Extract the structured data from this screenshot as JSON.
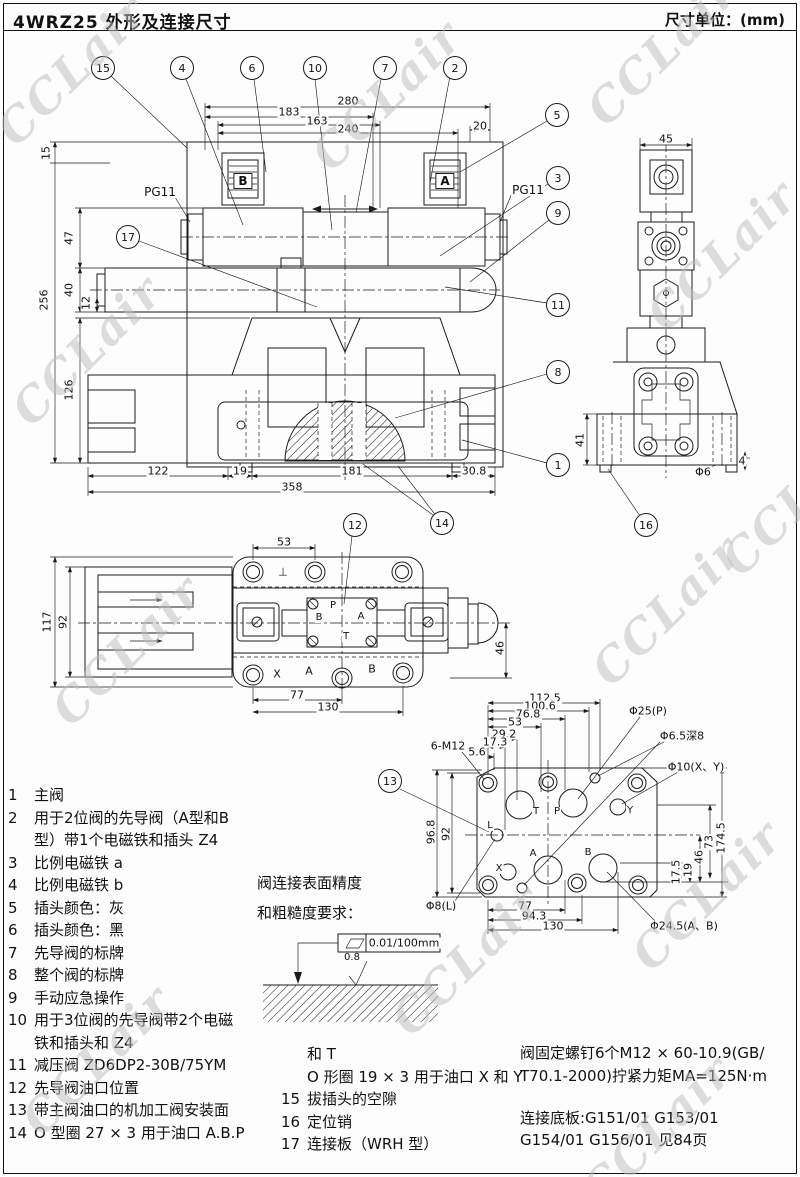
{
  "header": {
    "title": "4WRZ25 外形及连接尺寸",
    "unit": "尺寸单位：(mm)"
  },
  "watermark": {
    "text": "CCLair",
    "positions": [
      {
        "x": 5,
        "y": 110
      },
      {
        "x": 320,
        "y": 135
      },
      {
        "x": 595,
        "y": 90
      },
      {
        "x": 20,
        "y": 390
      },
      {
        "x": 655,
        "y": 295
      },
      {
        "x": 60,
        "y": 690
      },
      {
        "x": 600,
        "y": 650
      },
      {
        "x": 730,
        "y": 540
      },
      {
        "x": 400,
        "y": 1000
      },
      {
        "x": 640,
        "y": 935
      },
      {
        "x": 590,
        "y": 1170
      },
      {
        "x": 30,
        "y": 1100
      }
    ]
  },
  "annotations": {
    "callouts": [
      {
        "n": "15",
        "x": 103,
        "y": 68
      },
      {
        "n": "4",
        "x": 182,
        "y": 68
      },
      {
        "n": "6",
        "x": 252,
        "y": 68
      },
      {
        "n": "10",
        "x": 315,
        "y": 68
      },
      {
        "n": "7",
        "x": 385,
        "y": 68
      },
      {
        "n": "2",
        "x": 455,
        "y": 68
      },
      {
        "n": "5",
        "x": 557,
        "y": 115
      },
      {
        "n": "3",
        "x": 558,
        "y": 178
      },
      {
        "n": "9",
        "x": 558,
        "y": 213
      },
      {
        "n": "11",
        "x": 558,
        "y": 305
      },
      {
        "n": "8",
        "x": 558,
        "y": 372
      },
      {
        "n": "1",
        "x": 558,
        "y": 465
      },
      {
        "n": "17",
        "x": 128,
        "y": 237
      },
      {
        "n": "12",
        "x": 355,
        "y": 525
      },
      {
        "n": "14",
        "x": 442,
        "y": 523
      },
      {
        "n": "16",
        "x": 646,
        "y": 525
      },
      {
        "n": "13",
        "x": 390,
        "y": 781
      }
    ],
    "dims": [
      {
        "t": "280",
        "x": 348,
        "y": 101
      },
      {
        "t": "183",
        "x": 289,
        "y": 112
      },
      {
        "t": "163",
        "x": 317,
        "y": 121
      },
      {
        "t": "240",
        "x": 348,
        "y": 129
      },
      {
        "t": "20",
        "x": 480,
        "y": 126
      },
      {
        "t": "122",
        "x": 158,
        "y": 471
      },
      {
        "t": "19",
        "x": 240,
        "y": 471
      },
      {
        "t": "181",
        "x": 352,
        "y": 471
      },
      {
        "t": "30.8",
        "x": 474,
        "y": 471
      },
      {
        "t": "358",
        "x": 292,
        "y": 487
      },
      {
        "t": "15",
        "x": 46,
        "y": 153,
        "rot": 1
      },
      {
        "t": "256",
        "x": 44,
        "y": 300,
        "rot": 1
      },
      {
        "t": "47",
        "x": 69,
        "y": 238,
        "rot": 1
      },
      {
        "t": "40",
        "x": 69,
        "y": 290,
        "rot": 1
      },
      {
        "t": "12",
        "x": 86,
        "y": 303,
        "rot": 1
      },
      {
        "t": "126",
        "x": 69,
        "y": 390,
        "rot": 1
      },
      {
        "t": "45",
        "x": 666,
        "y": 139
      },
      {
        "t": "41",
        "x": 580,
        "y": 440,
        "rot": 1
      },
      {
        "t": "4",
        "x": 742,
        "y": 461
      },
      {
        "t": "53",
        "x": 284,
        "y": 542
      },
      {
        "t": "117",
        "x": 47,
        "y": 622,
        "rot": 1
      },
      {
        "t": "92",
        "x": 63,
        "y": 622,
        "rot": 1
      },
      {
        "t": "77",
        "x": 297,
        "y": 695
      },
      {
        "t": "130",
        "x": 328,
        "y": 707
      },
      {
        "t": "46",
        "x": 500,
        "y": 648,
        "rot": 1
      },
      {
        "t": "112.5",
        "x": 545,
        "y": 698
      },
      {
        "t": "100.6",
        "x": 540,
        "y": 706
      },
      {
        "t": "76.8",
        "x": 528,
        "y": 714
      },
      {
        "t": "53",
        "x": 515,
        "y": 722
      },
      {
        "t": "29.2",
        "x": 504,
        "y": 734
      },
      {
        "t": "17.3",
        "x": 495,
        "y": 742
      },
      {
        "t": "5.6",
        "x": 477,
        "y": 752
      },
      {
        "t": "96.8",
        "x": 431,
        "y": 832,
        "rot": 1
      },
      {
        "t": "92",
        "x": 446,
        "y": 834,
        "rot": 1
      },
      {
        "t": "17.5",
        "x": 676,
        "y": 872,
        "rot": 1
      },
      {
        "t": "19",
        "x": 688,
        "y": 870,
        "rot": 1
      },
      {
        "t": "46",
        "x": 699,
        "y": 857,
        "rot": 1
      },
      {
        "t": "73",
        "x": 709,
        "y": 842,
        "rot": 1
      },
      {
        "t": "174.5",
        "x": 721,
        "y": 838,
        "rot": 1
      },
      {
        "t": "77",
        "x": 525,
        "y": 906
      },
      {
        "t": "94.3",
        "x": 534,
        "y": 916
      },
      {
        "t": "130",
        "x": 553,
        "y": 926
      }
    ],
    "labels": [
      {
        "t": "PG11",
        "x": 160,
        "y": 192,
        "fs": 12
      },
      {
        "t": "PG11",
        "x": 528,
        "y": 190,
        "fs": 12
      },
      {
        "t": "B",
        "x": 243,
        "y": 181,
        "box": 1
      },
      {
        "t": "A",
        "x": 445,
        "y": 181,
        "box": 1
      },
      {
        "t": "Φ6",
        "x": 703,
        "y": 472
      },
      {
        "t": "⊥",
        "x": 283,
        "y": 572
      },
      {
        "t": "P",
        "x": 333,
        "y": 606,
        "fs": 10
      },
      {
        "t": "B",
        "x": 319,
        "y": 618,
        "fs": 10
      },
      {
        "t": "A",
        "x": 361,
        "y": 617,
        "fs": 10
      },
      {
        "t": "T",
        "x": 346,
        "y": 637,
        "fs": 10
      },
      {
        "t": "X",
        "x": 277,
        "y": 674
      },
      {
        "t": "A",
        "x": 309,
        "y": 671
      },
      {
        "t": "B",
        "x": 372,
        "y": 669
      },
      {
        "t": "6-M12",
        "x": 448,
        "y": 746
      },
      {
        "t": "Φ25(P)",
        "x": 648,
        "y": 711
      },
      {
        "t": "Φ6.5深8",
        "x": 682,
        "y": 736
      },
      {
        "t": "Φ10(X、Y)",
        "x": 696,
        "y": 767
      },
      {
        "t": "Φ8(L)",
        "x": 441,
        "y": 906
      },
      {
        "t": "Φ24.5(A、B)",
        "x": 684,
        "y": 926
      },
      {
        "t": "L",
        "x": 490,
        "y": 826,
        "fs": 10
      },
      {
        "t": "X",
        "x": 499,
        "y": 869,
        "fs": 10
      },
      {
        "t": "T",
        "x": 536,
        "y": 812,
        "fs": 10
      },
      {
        "t": "P",
        "x": 557,
        "y": 812,
        "fs": 10
      },
      {
        "t": "Y",
        "x": 630,
        "y": 811,
        "fs": 10
      },
      {
        "t": "A",
        "x": 533,
        "y": 854,
        "fs": 10
      },
      {
        "t": "B",
        "x": 588,
        "y": 853,
        "fs": 10
      },
      {
        "t": "0.01/100mm",
        "x": 404,
        "y": 943
      },
      {
        "t": "0.8",
        "x": 352,
        "y": 958,
        "fs": 10
      }
    ]
  },
  "surface_note": {
    "line1": "阀连接表面精度",
    "line2": "和粗糙度要求："
  },
  "parts_list": [
    {
      "no": "1",
      "lines": [
        "主阀"
      ]
    },
    {
      "no": "2",
      "lines": [
        "用于2位阀的先导阀（A型和B",
        "型）带1个电磁铁和插头 Z4"
      ]
    },
    {
      "no": "3",
      "lines": [
        "比例电磁铁 a"
      ]
    },
    {
      "no": "4",
      "lines": [
        "比例电磁铁 b"
      ]
    },
    {
      "no": "5",
      "lines": [
        "插头颜色：灰"
      ]
    },
    {
      "no": "6",
      "lines": [
        "插头颜色：黑"
      ]
    },
    {
      "no": "7",
      "lines": [
        "先导阀的标牌"
      ]
    },
    {
      "no": "8",
      "lines": [
        "整个阀的标牌"
      ]
    },
    {
      "no": "9",
      "lines": [
        "手动应急操作"
      ]
    },
    {
      "no": "10",
      "lines": [
        "用于3位阀的先导阀带2个电磁",
        "铁和插头和 Z4"
      ]
    },
    {
      "no": "11",
      "lines": [
        "减压阀  ZD6DP2-30B/75YM"
      ]
    },
    {
      "no": "12",
      "lines": [
        "先导阀油口位置"
      ]
    },
    {
      "no": "13",
      "lines": [
        "带主阀油口的机加工阀安装面"
      ]
    },
    {
      "no": "14",
      "lines": [
        "O 型圈 27 × 3 用于油口 A.B.P"
      ]
    }
  ],
  "extra_lines": [
    "和 T",
    "O 形圈 19 × 3 用于油口 X 和 Y"
  ],
  "extra_items": [
    {
      "no": "15",
      "lines": [
        "拔插头的空隙"
      ]
    },
    {
      "no": "16",
      "lines": [
        "定位销"
      ]
    },
    {
      "no": "17",
      "lines": [
        "连接板（WRH 型）"
      ]
    }
  ],
  "notes": {
    "screw_lines": [
      "阀固定螺钉6个M12 × 60-10.9(GB/",
      "T70.1-2000)拧紧力矩MA=125N·m"
    ],
    "baseplate_lines": [
      "连接底板:G151/01   G153/01",
      "G154/01 G156/01   见84页"
    ]
  }
}
